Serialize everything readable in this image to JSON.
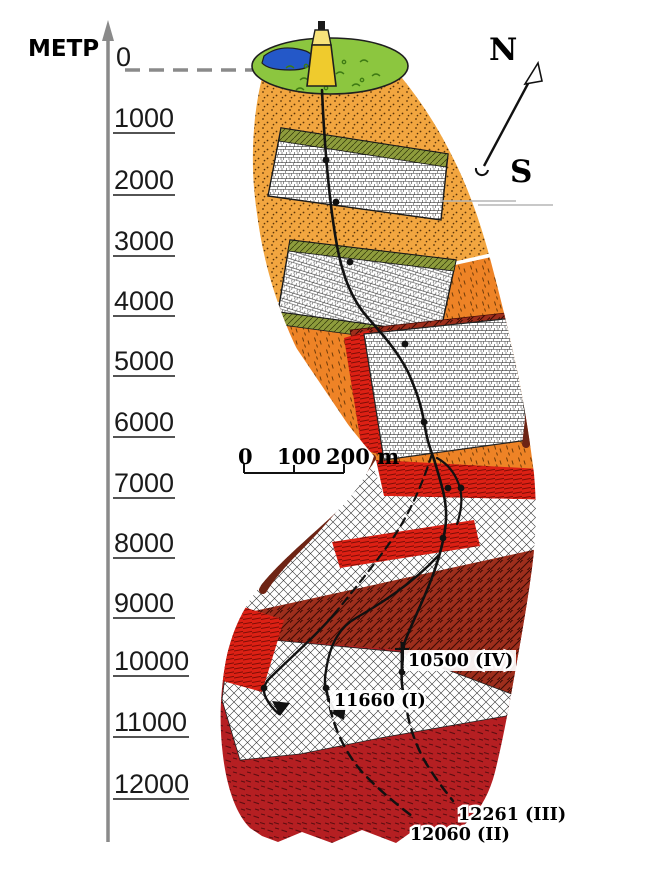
{
  "axis": {
    "unit": "МЕТР",
    "ticks": [
      "0",
      "1000",
      "2000",
      "3000",
      "4000",
      "5000",
      "6000",
      "7000",
      "8000",
      "9000",
      "10000",
      "11000",
      "12000"
    ]
  },
  "compass": {
    "north": "N",
    "south": "S"
  },
  "scale_bar": {
    "zero": "0",
    "hundred": "100",
    "two_hundred": "200 m"
  },
  "boreholes": {
    "branch_iv": "10500 (IV)",
    "branch_i": "11660 (I)",
    "branch_iii": "12261 (III)",
    "branch_ii": "12060 (II)"
  },
  "colors": {
    "axis_gray": "#8a8a8a",
    "surface_green": "#8CC63F",
    "pond_blue": "#2458C8",
    "derrick_yellow": "#EFCB2D",
    "orange_top": "#F2A640",
    "orange_mid": "#EE8326",
    "bright_red": "#DC2014",
    "maroon": "#9E2E1C",
    "crimson": "#B51F22",
    "olive": "#8E9C3C"
  }
}
